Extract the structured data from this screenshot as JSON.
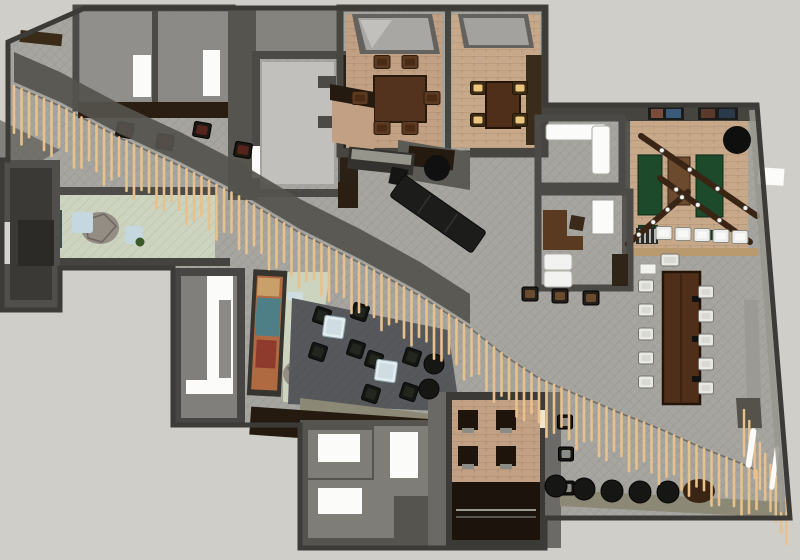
{
  "scene": {
    "width": 800,
    "height": 560,
    "description": "Top-down 3D architectural render of an office/hospitality floor plan crossed by a diagonal timber slat screen"
  },
  "palette": {
    "background": "#cfcec9",
    "wall_dark": "#3c3b38",
    "wall_mid": "#55544e",
    "wall_light": "#98978f",
    "carpet": "#a6a5a0",
    "carpet_dark": "#56585c",
    "floor_empty": "#c1c0bc",
    "floor_room": "#908f8b",
    "brick": "#c1a084",
    "brick_light": "#c7a98a",
    "wood_dark": "#241a10",
    "wood_mid": "#53331d",
    "wood_table": "#4f2f1a",
    "sage": "#ccd3bf",
    "green_table": "#1d4a2a",
    "slat": "#e8c18c",
    "bulkhead": "#55534d",
    "white": "#fbfbf9",
    "cream": "#efe6cc",
    "cushion_tan": "#ecc57e",
    "chair_white": "#e8e8e5",
    "black": "#161715",
    "olive": "#8b8975",
    "lightblue": "#c6d8df",
    "teal_desk": "#3f4f4e",
    "mural_orange": "#b06a42",
    "mural_teal": "#4e7e86",
    "mural_red": "#8e3b2e",
    "mural_sand": "#c9a06a",
    "rock": "#948d83",
    "beam_brown": "#3a2414"
  },
  "slat_screen": {
    "spacing": 7.5,
    "length": 48,
    "stroke_width": 2.6,
    "path": [
      [
        14,
        86
      ],
      [
        60,
        106
      ],
      [
        120,
        138
      ],
      [
        180,
        166
      ],
      [
        240,
        197
      ],
      [
        300,
        233
      ],
      [
        360,
        263
      ],
      [
        420,
        296
      ],
      [
        470,
        328
      ],
      [
        505,
        356
      ],
      [
        540,
        379
      ],
      [
        580,
        396
      ],
      [
        620,
        413
      ],
      [
        660,
        429
      ],
      [
        700,
        447
      ],
      [
        740,
        463
      ],
      [
        758,
        471
      ]
    ],
    "wall_slats": {
      "x": 744,
      "y": 410,
      "count": 9,
      "dx": 5.3,
      "dy": 11,
      "length": 46
    }
  },
  "furniture": {
    "conference_chairs_left": [
      [
        646,
        286
      ],
      [
        646,
        310
      ],
      [
        646,
        334
      ],
      [
        646,
        358
      ],
      [
        646,
        382
      ]
    ],
    "conference_chairs_right": [
      [
        706,
        292
      ],
      [
        706,
        316
      ],
      [
        706,
        340
      ],
      [
        706,
        364
      ],
      [
        706,
        388
      ]
    ],
    "conference_head": [
      [
        670,
        260
      ]
    ],
    "dining1_chairs": [
      [
        382,
        62
      ],
      [
        410,
        62
      ],
      [
        382,
        128
      ],
      [
        410,
        128
      ],
      [
        360,
        98
      ],
      [
        432,
        98
      ]
    ],
    "dining2_chairs": [
      [
        478,
        88
      ],
      [
        520,
        88
      ],
      [
        478,
        120
      ],
      [
        520,
        120
      ]
    ],
    "lounge_chairs": [
      [
        322,
        316
      ],
      [
        360,
        312
      ],
      [
        318,
        352
      ],
      [
        356,
        349
      ],
      [
        374,
        360
      ],
      [
        412,
        357
      ],
      [
        371,
        394
      ],
      [
        409,
        392
      ]
    ],
    "lounge_tables": [
      [
        334,
        327
      ],
      [
        386,
        371
      ]
    ],
    "lounge_poufs": [
      [
        434,
        364
      ],
      [
        429,
        389
      ]
    ],
    "floor_poufs": [
      [
        556,
        486
      ],
      [
        584,
        489
      ],
      [
        612,
        491
      ],
      [
        640,
        492
      ],
      [
        668,
        492
      ]
    ],
    "white_stool_row": [
      [
        664,
        233
      ],
      [
        683,
        234
      ],
      [
        702,
        235
      ],
      [
        721,
        236
      ],
      [
        740,
        237
      ]
    ],
    "bar_stools": [
      [
        125,
        130
      ],
      [
        165,
        142
      ],
      [
        202,
        130
      ],
      [
        243,
        150
      ]
    ],
    "desk_stools": [
      [
        530,
        294
      ],
      [
        560,
        296
      ],
      [
        591,
        298
      ]
    ],
    "side_chairs": [
      [
        565,
        422
      ],
      [
        566,
        454
      ],
      [
        567,
        488
      ]
    ],
    "games_beams": [
      [
        641,
        136,
        757,
        216
      ],
      [
        660,
        178,
        750,
        242
      ],
      [
        628,
        244,
        688,
        192
      ]
    ]
  }
}
